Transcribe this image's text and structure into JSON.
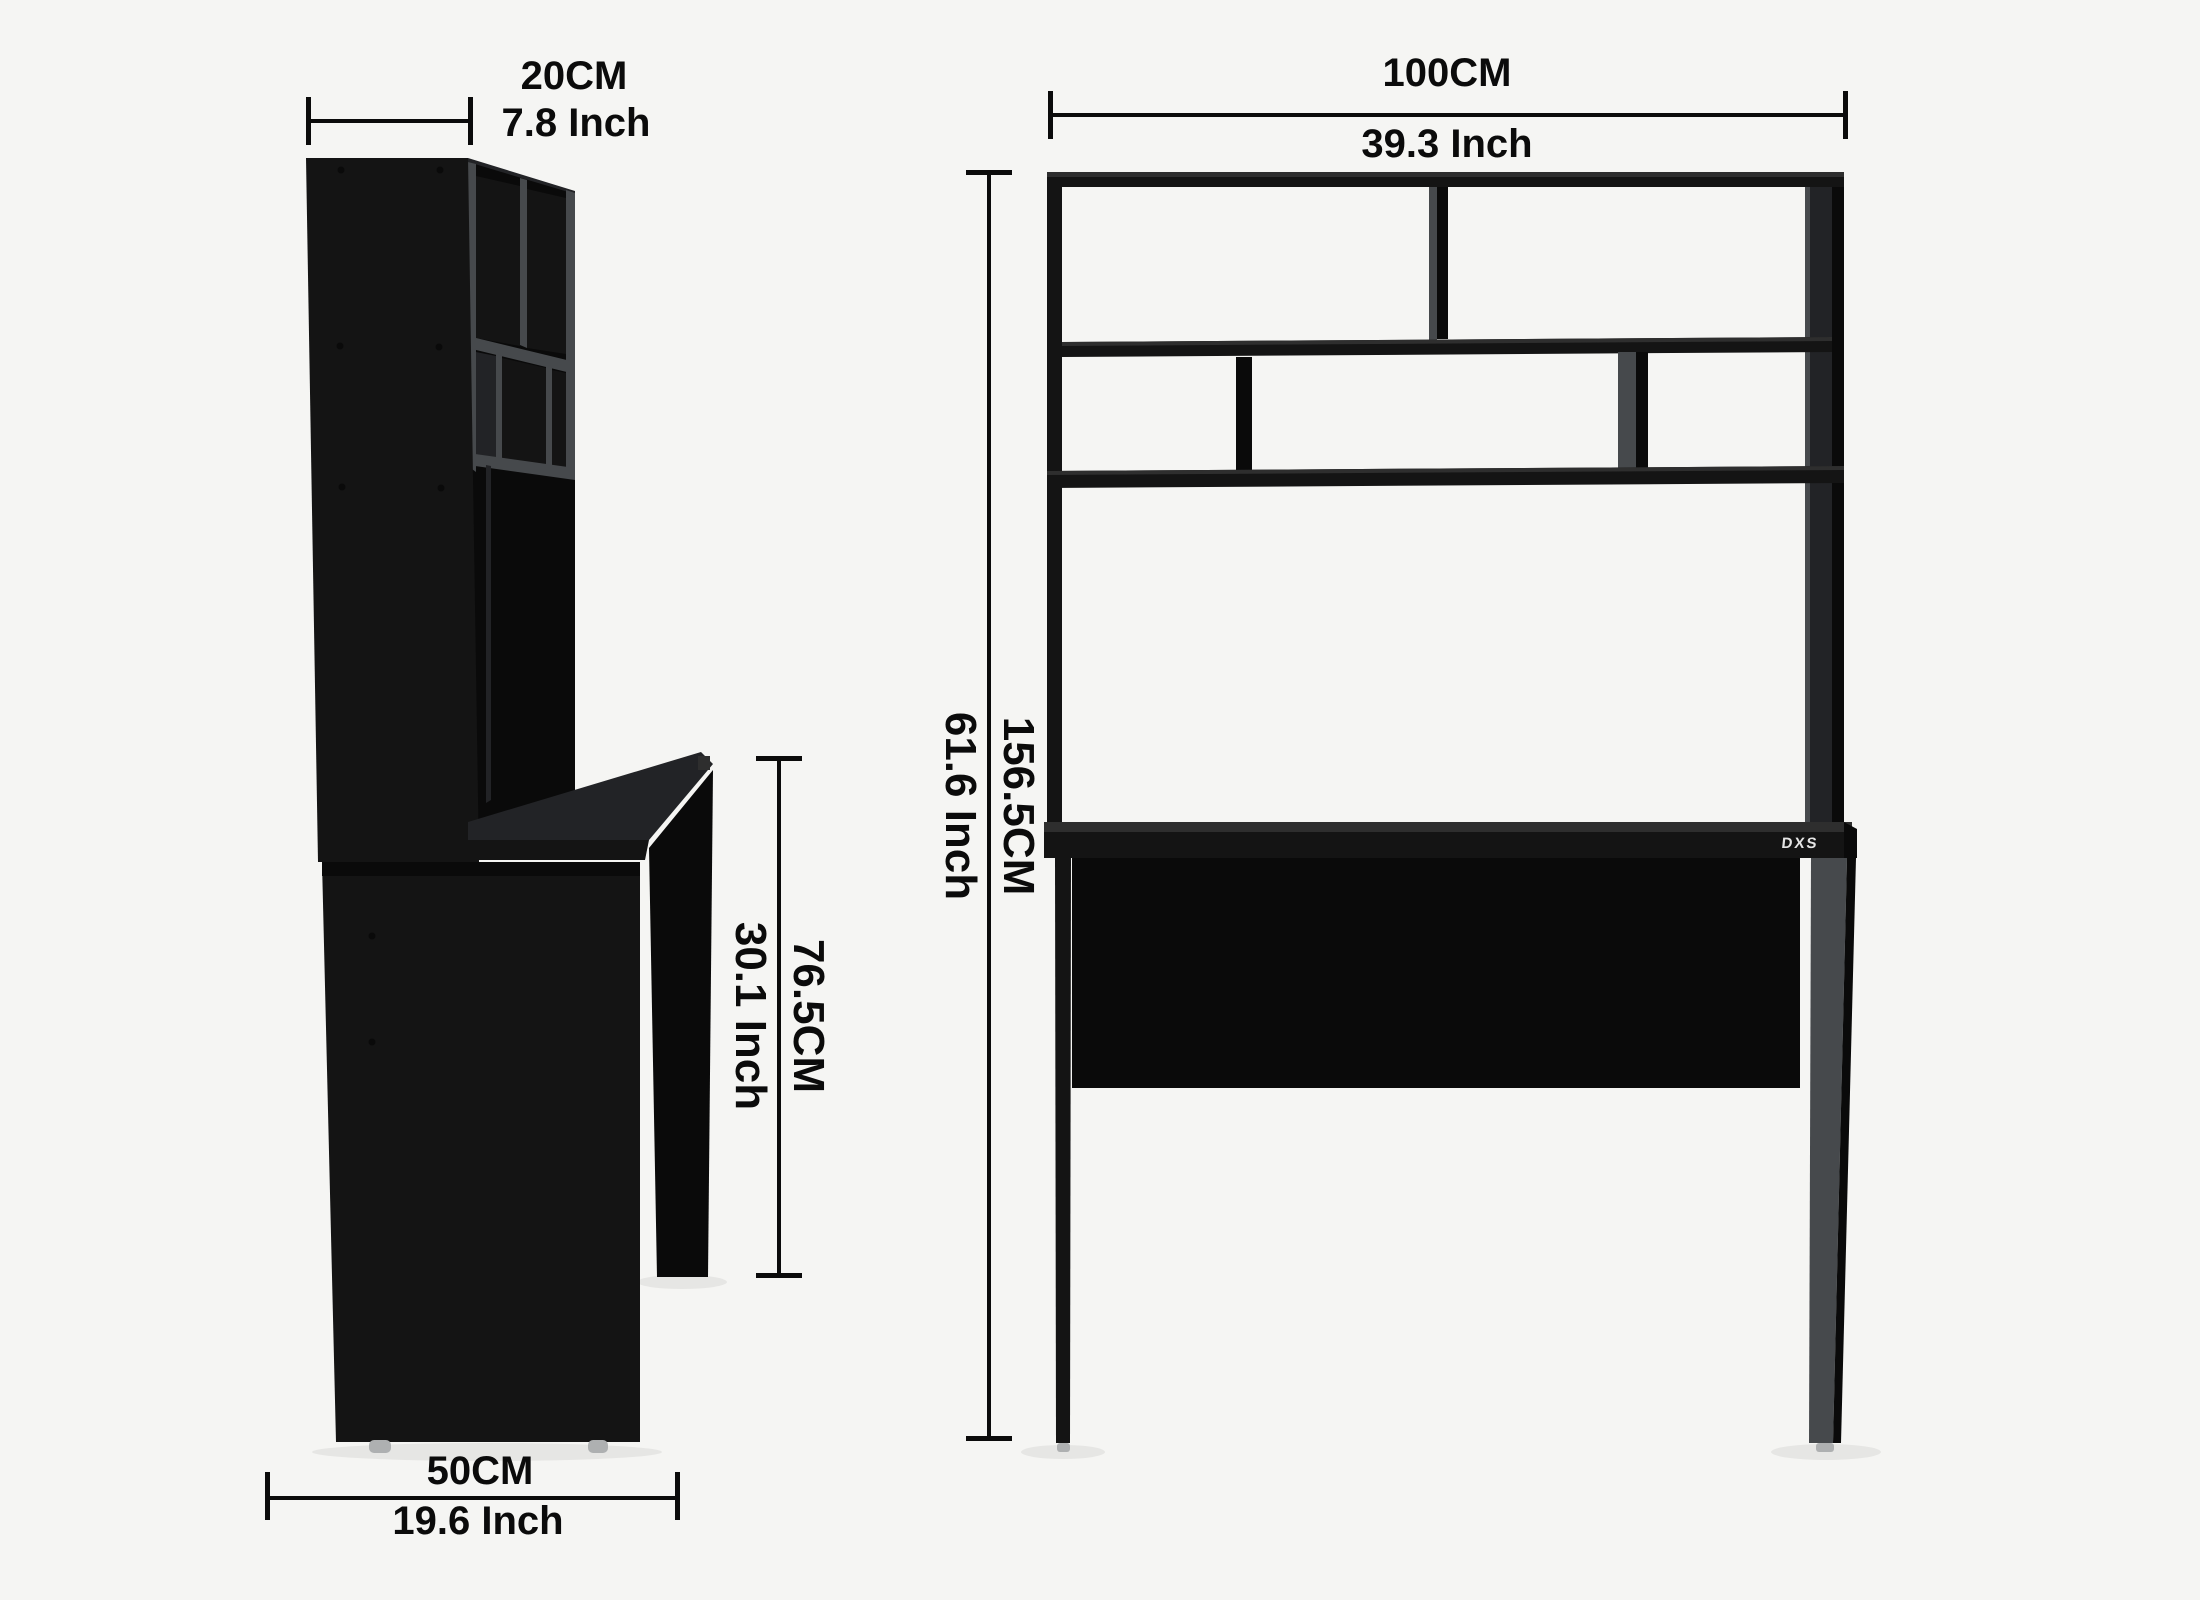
{
  "title": "Desk with hutch dimension diagram",
  "logo": {
    "text": "DXS"
  },
  "dimensions": {
    "hutch_depth": {
      "cm": "20CM",
      "inch": "7.8 Inch"
    },
    "overall_width": {
      "cm": "100CM",
      "inch": "39.3 Inch"
    },
    "overall_height": {
      "cm": "156.5CM",
      "inch": "61.6 Inch"
    },
    "desk_height": {
      "cm": "76.5CM",
      "inch": "30.1 Inch"
    },
    "desk_depth": {
      "cm": "50CM",
      "inch": "19.6 Inch"
    }
  },
  "colors": {
    "bg": "#f5f5f3",
    "ink": "#0a0a0a",
    "panel": "#141414",
    "face": "#222326",
    "hl": "#2e2e2e",
    "board": "#46494c",
    "foot": "#aeb0b1",
    "dim": "#0b0b0b",
    "logo": "#e4e4e4"
  }
}
